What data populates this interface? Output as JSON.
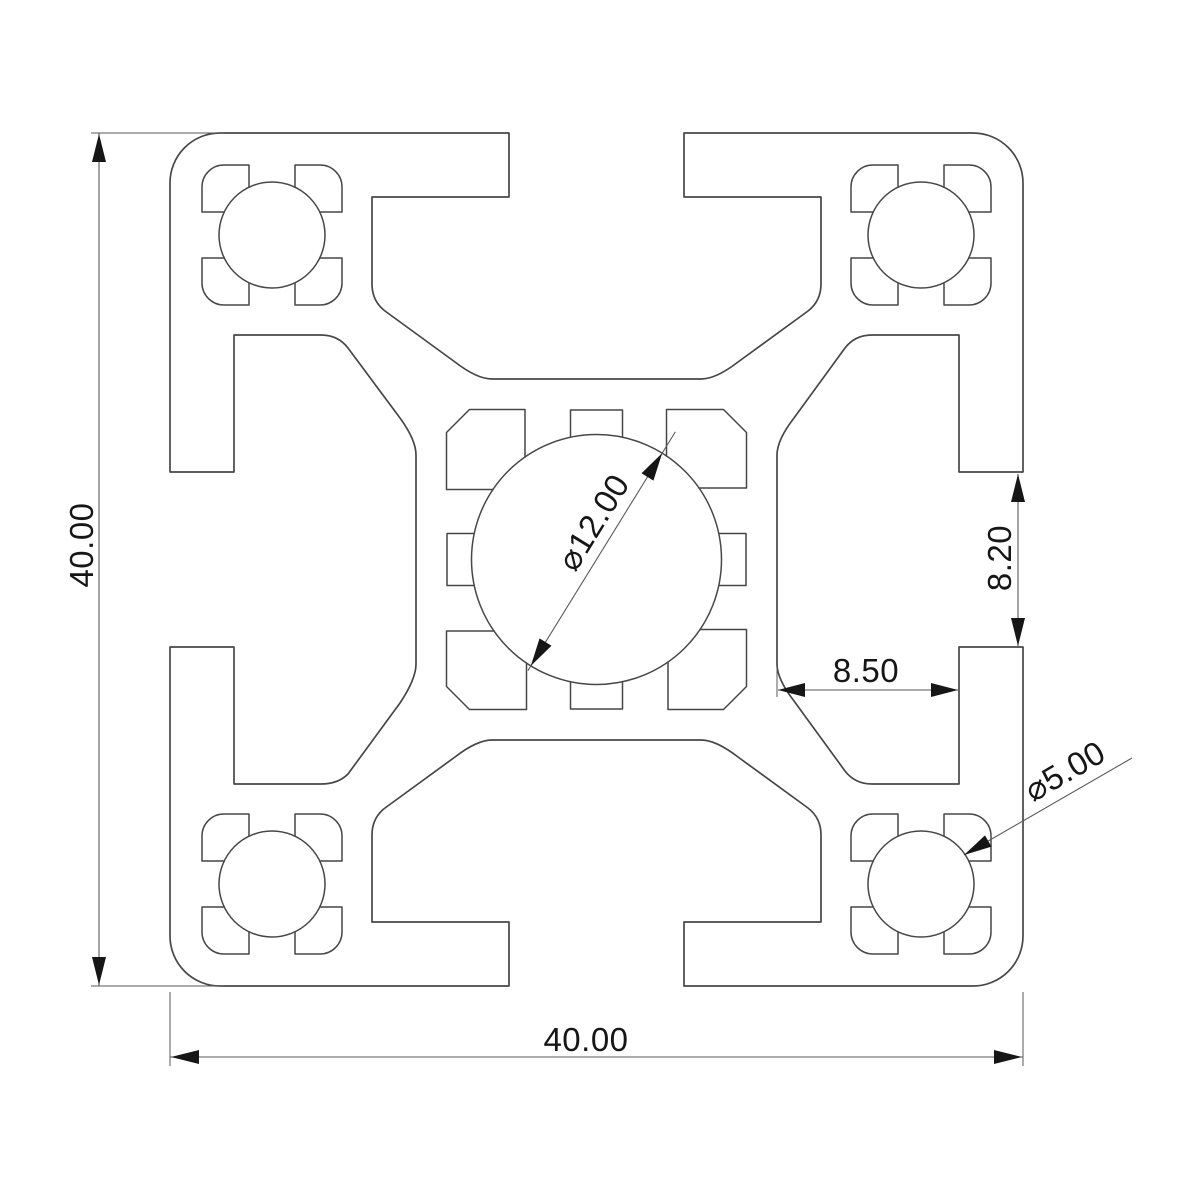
{
  "dims": {
    "height": "40.00",
    "width": "40.00",
    "slot_opening": "8.20",
    "slot_depth": "8.50",
    "center_bore": "⌀12.00",
    "corner_bore": "⌀5.00"
  },
  "style": {
    "background": "#ffffff",
    "outline_color": "#474747",
    "dimension_line_color": "#5a5a5a",
    "text_color": "#161616"
  }
}
